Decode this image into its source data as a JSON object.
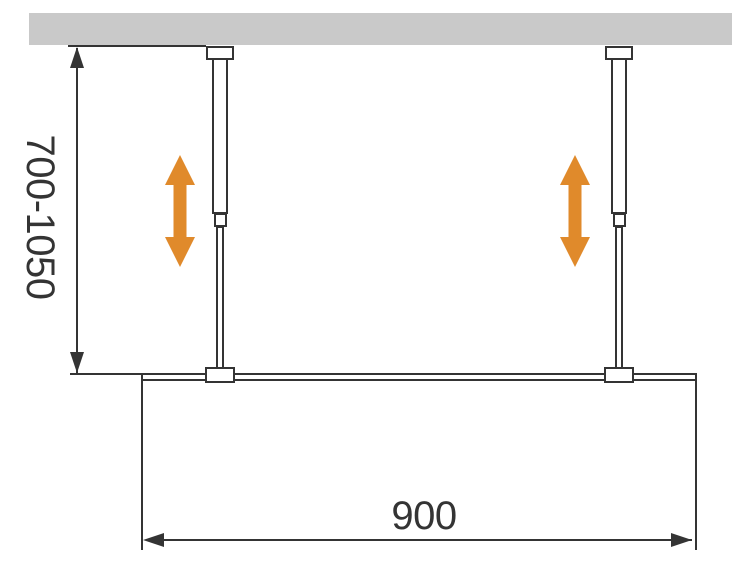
{
  "diagram": {
    "labels": {
      "height_range": "700-1050",
      "width": "900"
    },
    "colors": {
      "ceiling": "#c9c9c9",
      "line": "#343434",
      "accent_orange": "#e08a2b",
      "background": "#ffffff"
    }
  }
}
